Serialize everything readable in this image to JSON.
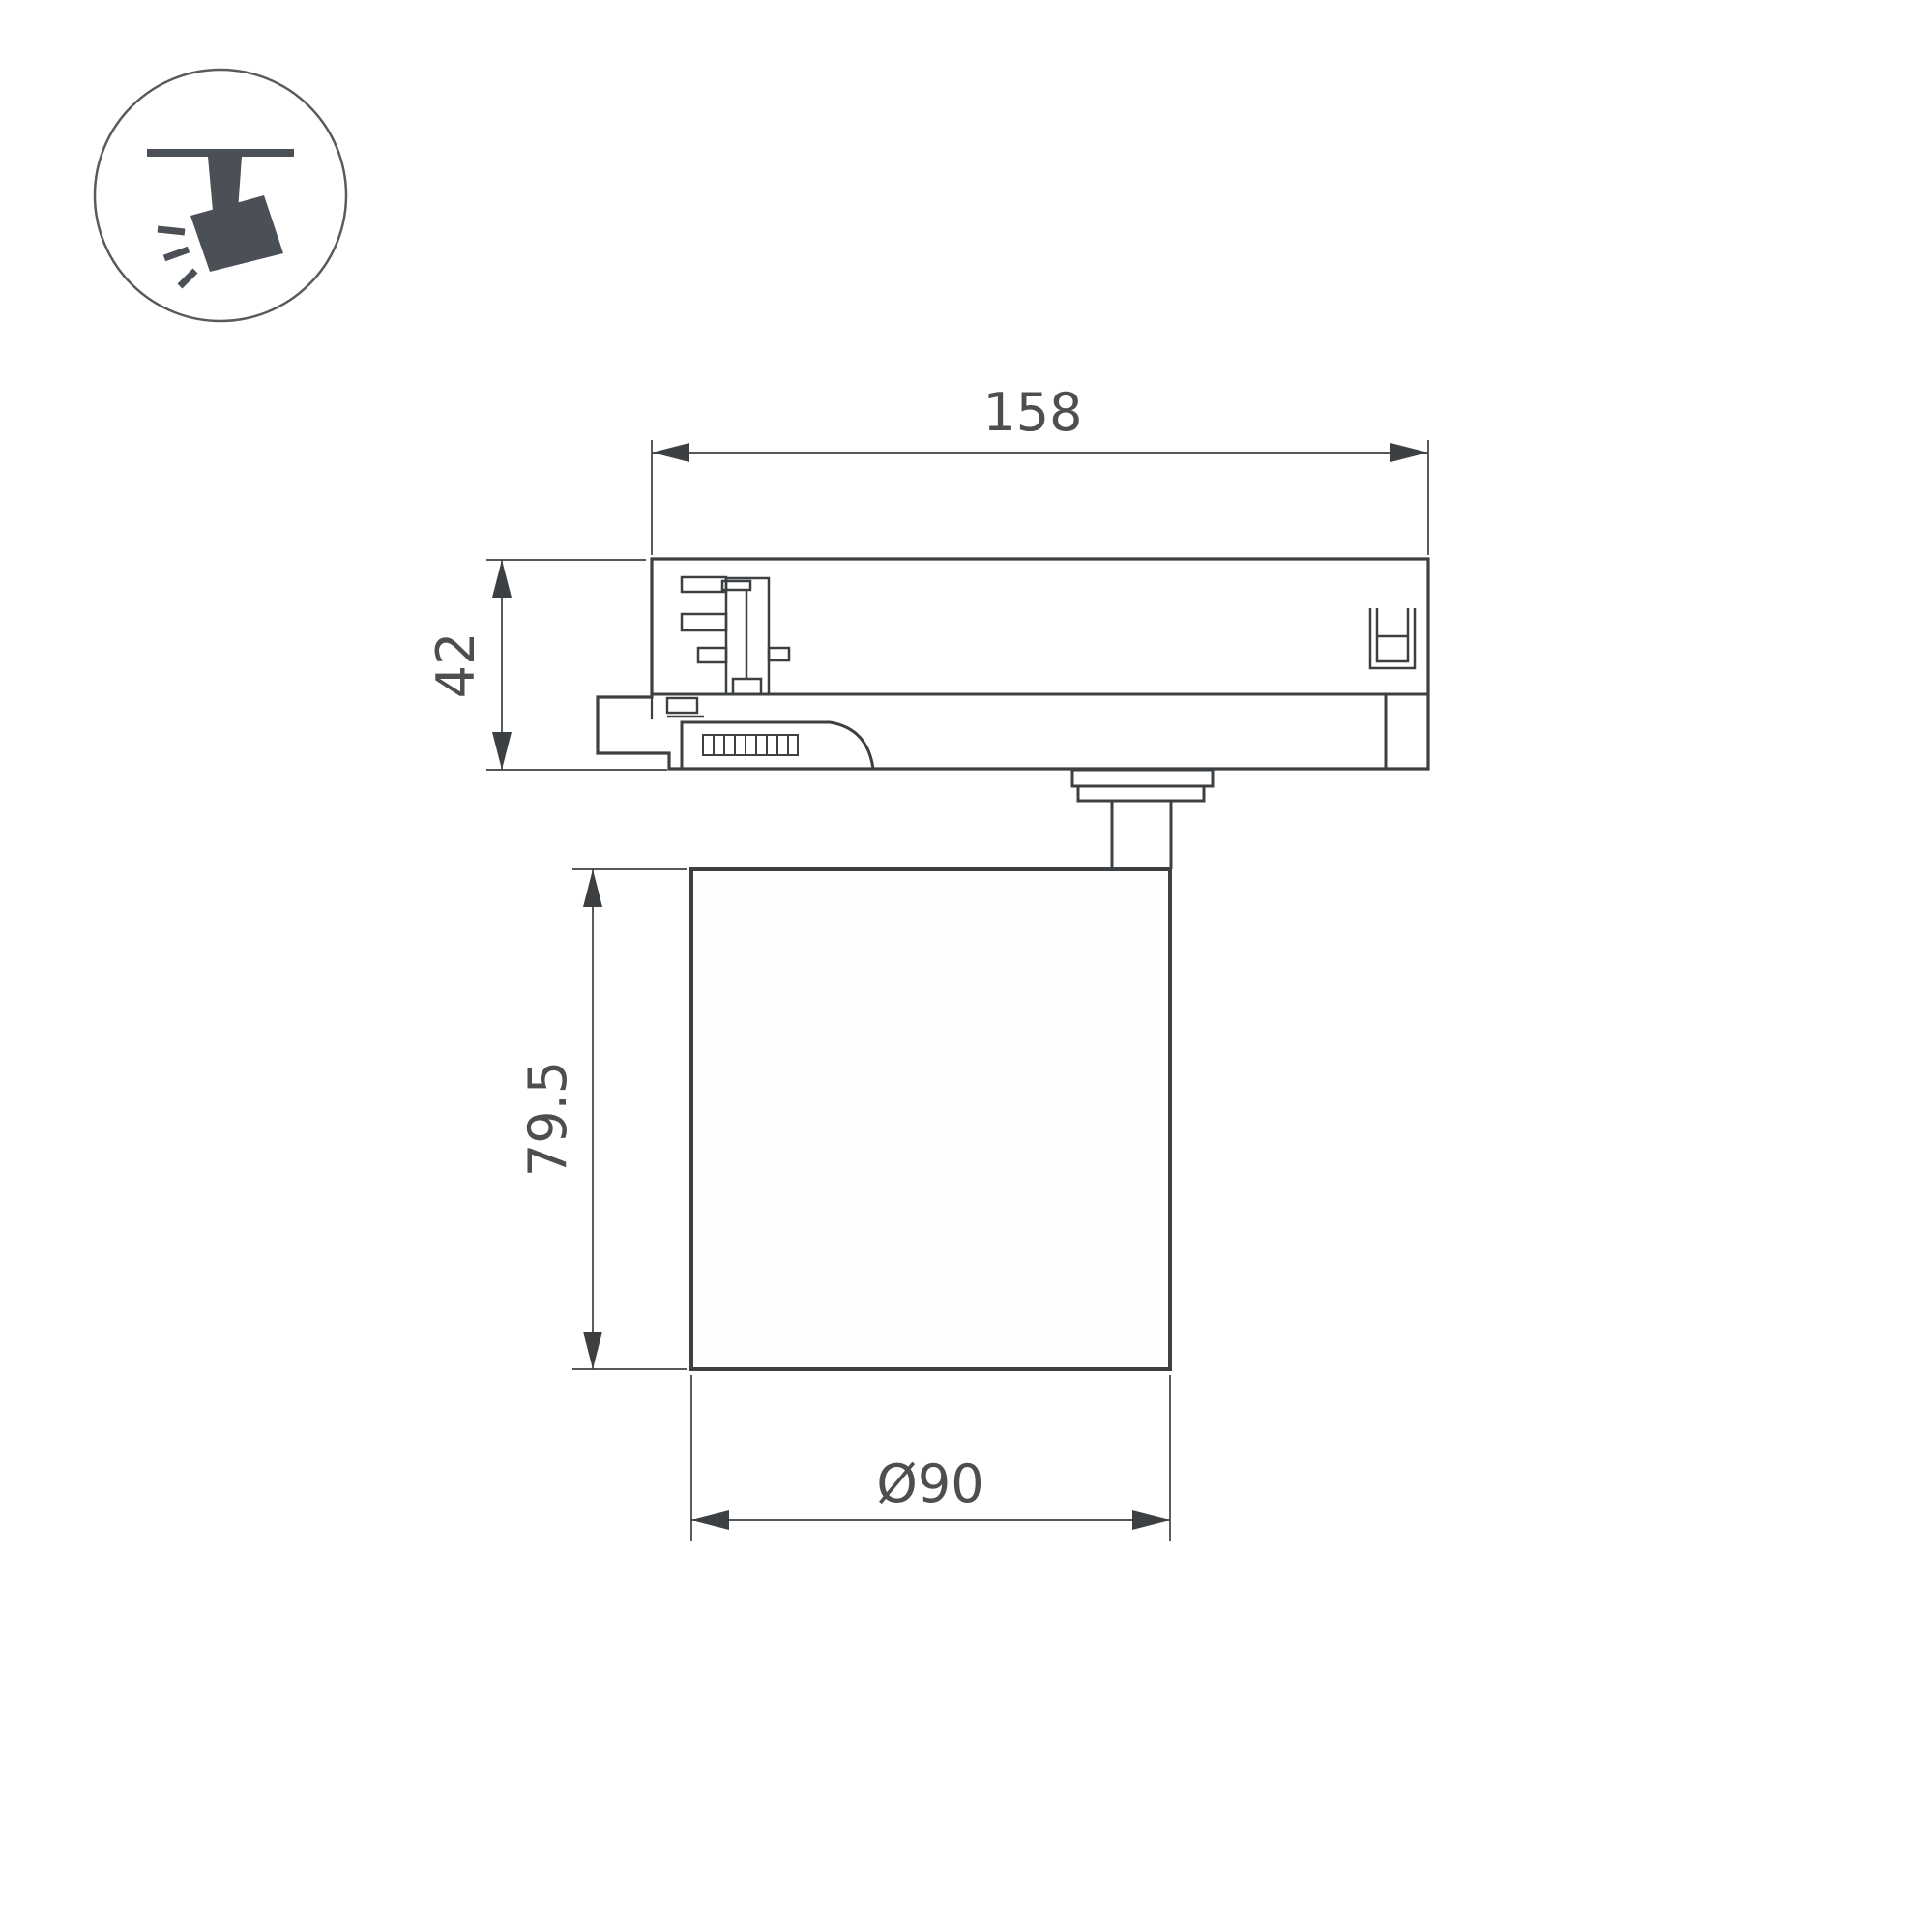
{
  "page": {
    "background": "#ffffff"
  },
  "icon": {
    "name": "track-spotlight",
    "shape_color": "#4a5056",
    "circle_stroke_color": "#595a5c"
  },
  "drawing": {
    "line_color": "#3d4043",
    "text_color": "#4c4e50",
    "dimensions": {
      "track_length": {
        "value": "158",
        "orientation": "horizontal",
        "measures": "track adapter length"
      },
      "adapter_height": {
        "value": "42",
        "orientation": "vertical",
        "measures": "track adapter height"
      },
      "body_height": {
        "value": "79.5",
        "orientation": "vertical",
        "measures": "lamp body height"
      },
      "body_diameter": {
        "value": "Ø90",
        "orientation": "horizontal",
        "measures": "lamp body diameter"
      }
    }
  }
}
